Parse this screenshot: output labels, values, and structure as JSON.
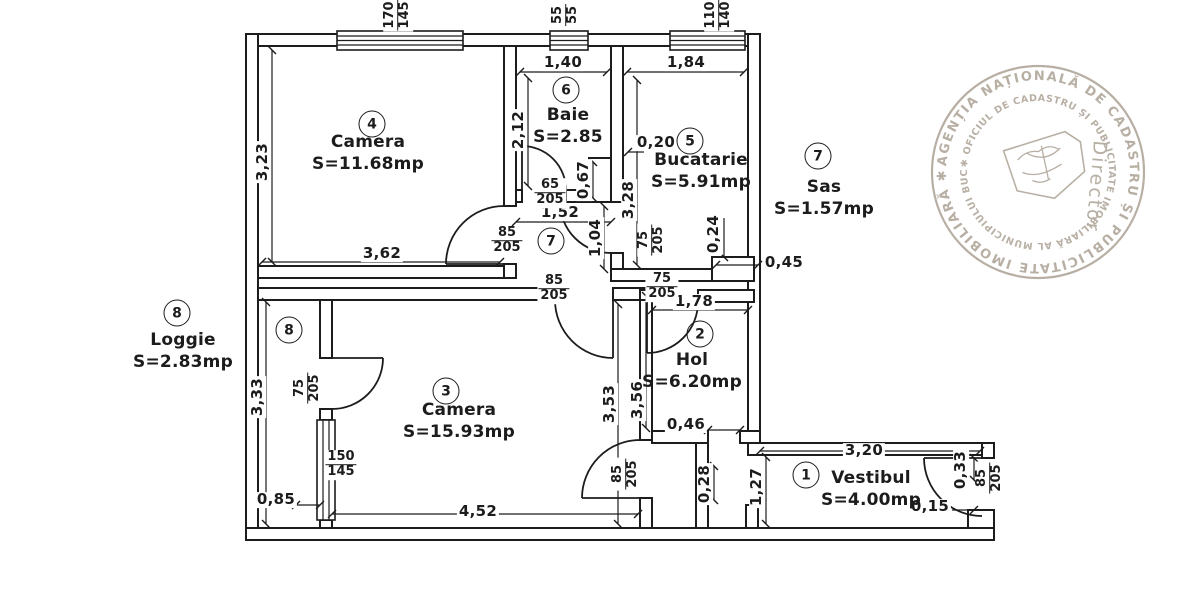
{
  "colors": {
    "ink": "#1c1c1c",
    "paper": "#ffffff",
    "stamp": "#a79c8e"
  },
  "stamp": {
    "outer_text": "AGENȚIA NAȚIONALĂ DE CADASTRU ȘI PUBLICITATE IMOBILIARĂ ✱",
    "inner_text": "✱ OFICIUL DE CADASTRU ȘI PUBLICITATE IMOBILIARĂ AL MUNICIPIULUI BUCUREȘTI",
    "center_text": "Director"
  },
  "annotations": {
    "room_labels": [
      {
        "name": "Camera",
        "area": "S=11.68mp",
        "x": 368,
        "y": 153
      },
      {
        "name": "Baie",
        "area": "S=2.85",
        "x": 568,
        "y": 126
      },
      {
        "name": "Bucatarie",
        "area": "S=5.91mp",
        "x": 701,
        "y": 171
      },
      {
        "name": "Sas",
        "area": "S=1.57mp",
        "x": 824,
        "y": 198
      },
      {
        "name": "Hol",
        "area": "S=6.20mp",
        "x": 692,
        "y": 371
      },
      {
        "name": "Camera",
        "area": "S=15.93mp",
        "x": 459,
        "y": 421
      },
      {
        "name": "Vestibul",
        "area": "S=4.00mp",
        "x": 871,
        "y": 489
      },
      {
        "name": "Loggie",
        "area": "S=2.83mp",
        "x": 183,
        "y": 351
      }
    ],
    "room_numbers": [
      {
        "n": "4",
        "x": 372,
        "y": 124
      },
      {
        "n": "6",
        "x": 566,
        "y": 90
      },
      {
        "n": "5",
        "x": 690,
        "y": 141
      },
      {
        "n": "7",
        "x": 551,
        "y": 241
      },
      {
        "n": "7",
        "x": 818,
        "y": 156
      },
      {
        "n": "2",
        "x": 700,
        "y": 334
      },
      {
        "n": "3",
        "x": 446,
        "y": 391
      },
      {
        "n": "8",
        "x": 289,
        "y": 330
      },
      {
        "n": "8",
        "x": 177,
        "y": 313
      },
      {
        "n": "1",
        "x": 806,
        "y": 475
      }
    ],
    "dimensions": [
      {
        "t": "3,23",
        "x": 263,
        "y": 162,
        "r": -90
      },
      {
        "t": "3,62",
        "x": 382,
        "y": 254,
        "r": 0
      },
      {
        "t": "1,40",
        "x": 563,
        "y": 63,
        "r": 0
      },
      {
        "t": "2,12",
        "x": 519,
        "y": 130,
        "r": -90
      },
      {
        "t": "1,84",
        "x": 686,
        "y": 63,
        "r": 0
      },
      {
        "t": "3,28",
        "x": 629,
        "y": 200,
        "r": -90
      },
      {
        "t": "0,20",
        "x": 656,
        "y": 143,
        "r": 0
      },
      {
        "t": "0,67",
        "x": 584,
        "y": 180,
        "r": -90
      },
      {
        "t": "1,52",
        "x": 560,
        "y": 213,
        "r": 0
      },
      {
        "t": "1,04",
        "x": 596,
        "y": 238,
        "r": -90
      },
      {
        "t": "0,24",
        "x": 714,
        "y": 234,
        "r": -90
      },
      {
        "t": "0,45",
        "x": 784,
        "y": 263,
        "r": 0
      },
      {
        "t": "1,78",
        "x": 694,
        "y": 302,
        "r": 0
      },
      {
        "t": "3,56",
        "x": 638,
        "y": 400,
        "r": -90
      },
      {
        "t": "3,53",
        "x": 610,
        "y": 404,
        "r": -90
      },
      {
        "t": "0,46",
        "x": 686,
        "y": 425,
        "r": 0
      },
      {
        "t": "3,20",
        "x": 864,
        "y": 451,
        "r": 0
      },
      {
        "t": "1,27",
        "x": 757,
        "y": 487,
        "r": -90
      },
      {
        "t": "0,28",
        "x": 705,
        "y": 484,
        "r": -90
      },
      {
        "t": "4,52",
        "x": 478,
        "y": 512,
        "r": 0
      },
      {
        "t": "3,33",
        "x": 258,
        "y": 397,
        "r": -90
      },
      {
        "t": "0,85",
        "x": 276,
        "y": 500,
        "r": 0
      },
      {
        "t": "0,33",
        "x": 961,
        "y": 470,
        "r": -90
      },
      {
        "t": "0,15",
        "x": 930,
        "y": 507,
        "r": 0
      }
    ],
    "fractions": [
      {
        "top": "170",
        "bottom": "145",
        "x": 398,
        "y": 15,
        "r": -90
      },
      {
        "top": "55",
        "bottom": "55",
        "x": 566,
        "y": 15,
        "r": -90
      },
      {
        "top": "110",
        "bottom": "140",
        "x": 719,
        "y": 15,
        "r": -90
      },
      {
        "top": "65",
        "bottom": "205",
        "x": 550,
        "y": 193,
        "r": 0
      },
      {
        "top": "85",
        "bottom": "205",
        "x": 507,
        "y": 241,
        "r": 0
      },
      {
        "top": "85",
        "bottom": "205",
        "x": 554,
        "y": 289,
        "r": 0
      },
      {
        "top": "75",
        "bottom": "205",
        "x": 652,
        "y": 240,
        "r": -90
      },
      {
        "top": "75",
        "bottom": "205",
        "x": 662,
        "y": 287,
        "r": 0
      },
      {
        "top": "75",
        "bottom": "205",
        "x": 308,
        "y": 388,
        "r": -90
      },
      {
        "top": "150",
        "bottom": "145",
        "x": 341,
        "y": 465,
        "r": 0
      },
      {
        "top": "85",
        "bottom": "205",
        "x": 626,
        "y": 474,
        "r": -90
      },
      {
        "top": "85",
        "bottom": "205",
        "x": 990,
        "y": 478,
        "r": -90
      }
    ]
  }
}
